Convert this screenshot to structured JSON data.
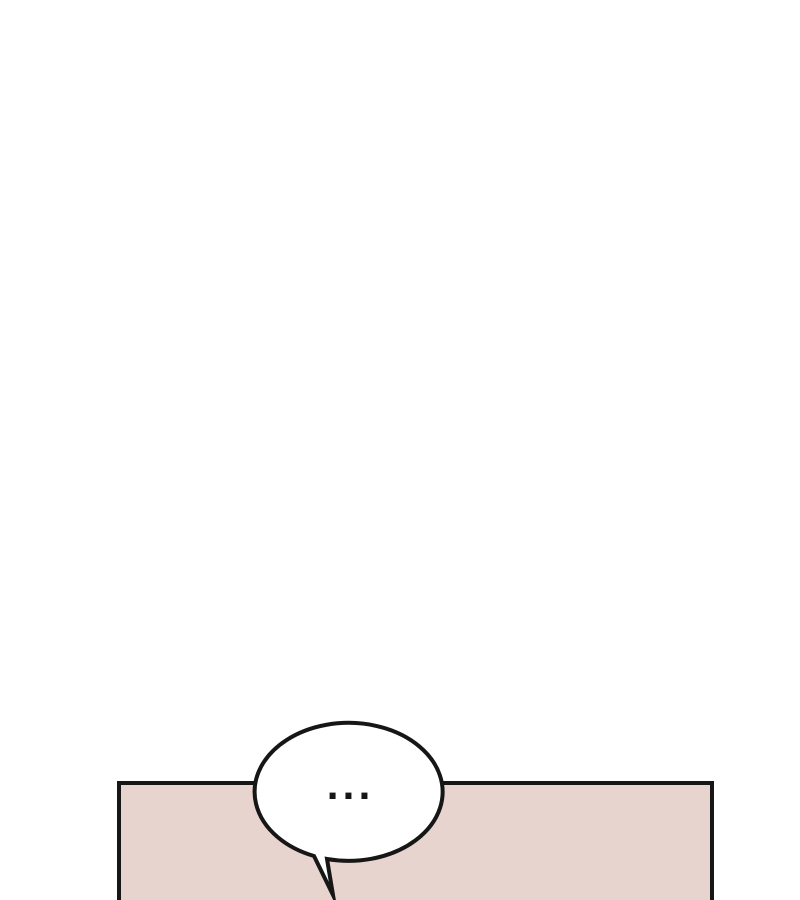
{
  "page": {
    "background": "#ffffff"
  },
  "panel": {
    "fill": "#e8d4ce",
    "stroke": "#161616"
  },
  "bubble": {
    "text": "...",
    "fill": "#ffffff",
    "stroke": "#161616",
    "text_color": "#161616"
  }
}
